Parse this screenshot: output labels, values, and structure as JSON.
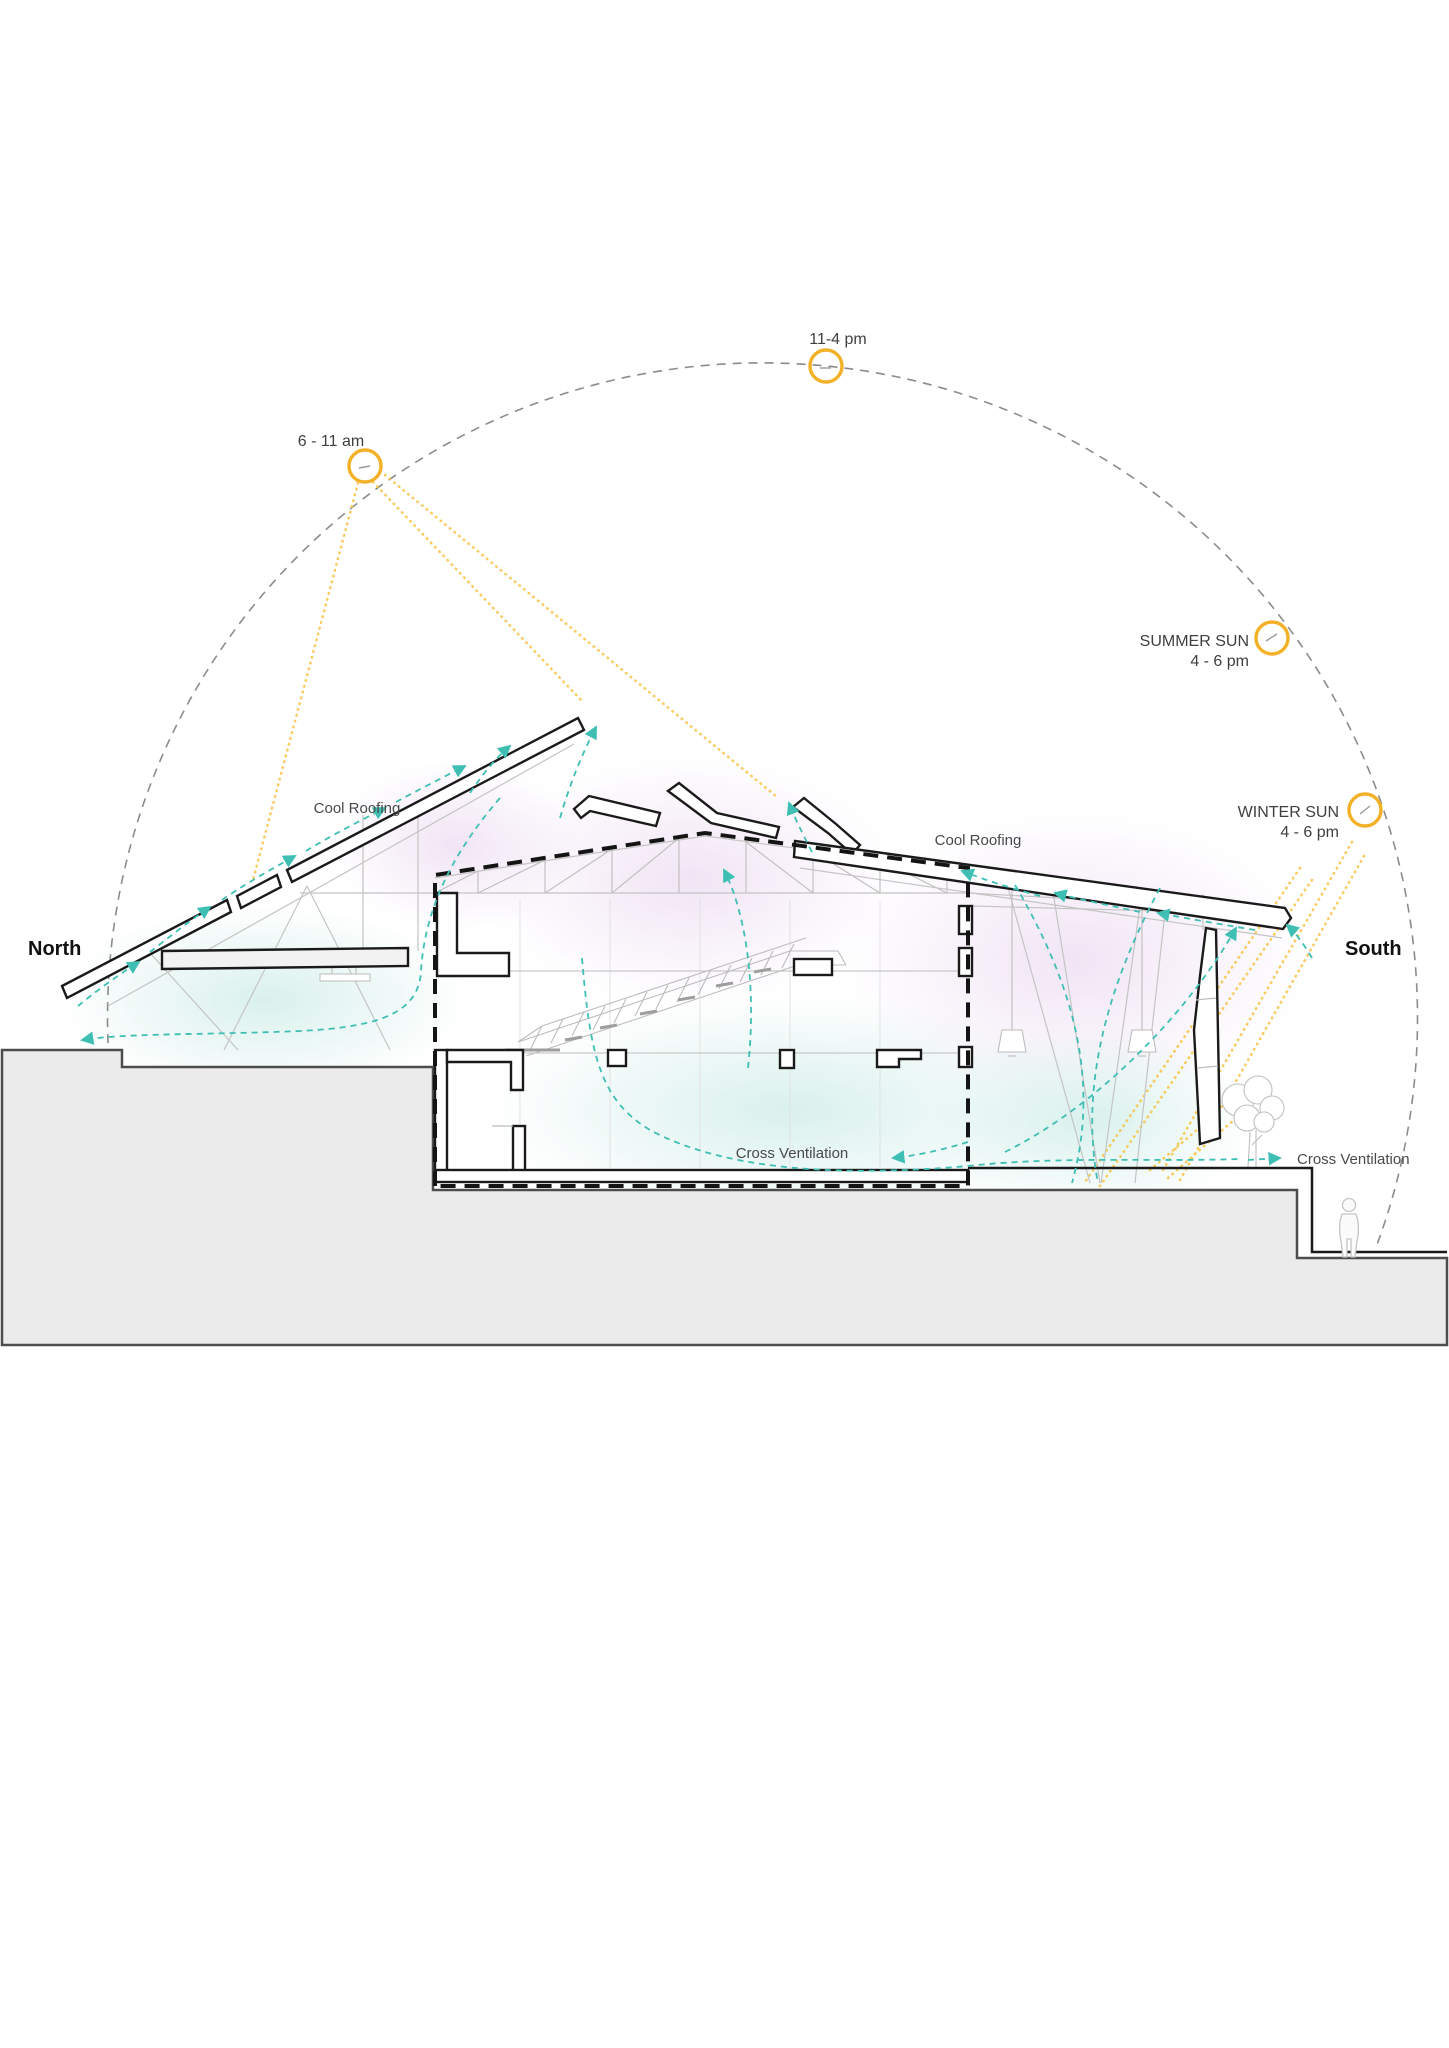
{
  "diagram": {
    "compass": {
      "north": "North",
      "south": "South"
    },
    "suns": {
      "midday": {
        "label": "11-4 pm"
      },
      "morning": {
        "label": "6 - 11 am"
      },
      "summer": {
        "name": "SUMMER SUN",
        "time": "4 - 6 pm"
      },
      "winter": {
        "name": "WINTER SUN",
        "time": "4 - 6 pm"
      }
    },
    "annotations": {
      "cool_roofing_left": "Cool Roofing",
      "cool_roofing_right": "Cool Roofing",
      "cross_ventilation_center": "Cross Ventilation",
      "cross_ventilation_right": "Cross Ventilation"
    },
    "colors": {
      "sun_yellow": "#F2B126",
      "ray_yellow": "#F8C345",
      "airflow_teal": "#3FBFB4",
      "arc_gray": "#8C8C8C",
      "ink": "#1A1A1A",
      "structure_gray": "#C4C4C4",
      "ground_fill": "#EBEBEB",
      "ground_edge": "#4D4D4D",
      "wash_pink": "#EBD9F0",
      "wash_cyan": "#CFEDE8"
    }
  }
}
